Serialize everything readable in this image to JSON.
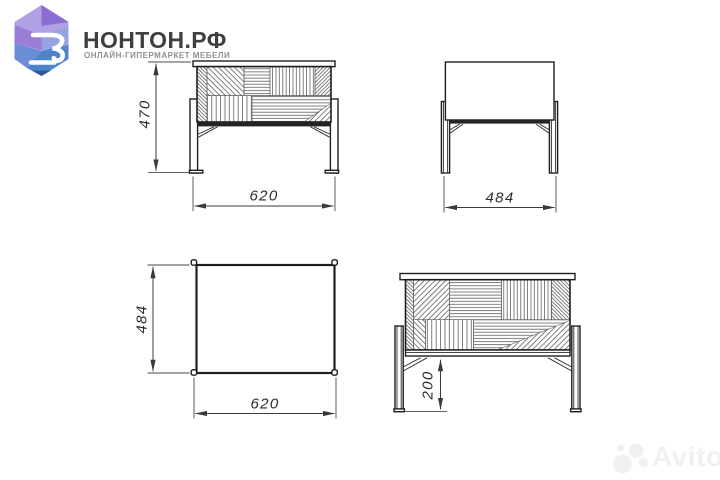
{
  "brand": {
    "title": "НОНТОН.РФ",
    "tagline": "ОНЛАЙН-ГИПЕРМАРКЕТ МЕБЕЛИ"
  },
  "drawing": {
    "type": "furniture-technical-drawing",
    "views": [
      "front",
      "side",
      "plan",
      "front-shelf-height"
    ],
    "front_view": {
      "height_mm": "470",
      "width_mm": "620"
    },
    "side_view": {
      "depth_mm": "484"
    },
    "plan_view": {
      "depth_mm": "484",
      "width_mm": "620"
    },
    "shelf": {
      "height_mm": "200"
    }
  },
  "watermark": {
    "text": "Avito"
  },
  "colors": {
    "ink": "#1e1e1e",
    "hatch": "#5a5a5a",
    "dimension": "#3a3a3a",
    "brand_text": "#3f3f3f",
    "brand_tagline": "#8f8f8f",
    "logo_lavender": "#b2a0e5",
    "logo_purple": "#8b6ed1",
    "logo_blue": "#5e8ad2",
    "logo_navy": "#33589e",
    "watermark_gray": "#f0f0f0"
  }
}
